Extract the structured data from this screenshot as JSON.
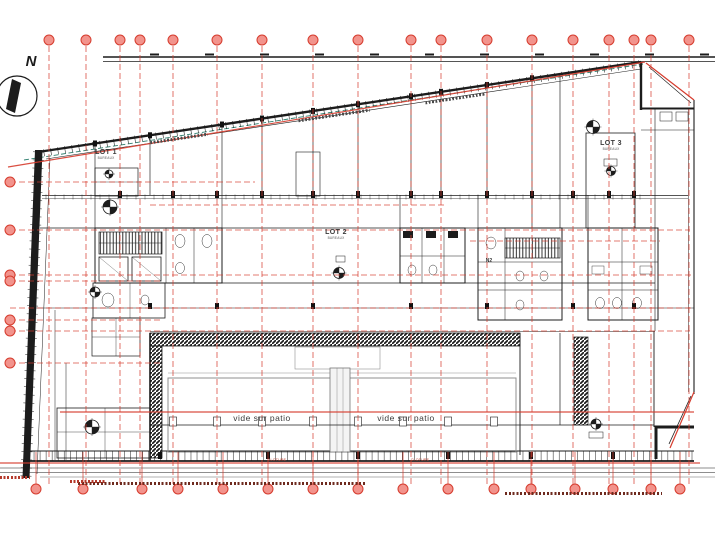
{
  "drawing": {
    "compass_label": "N",
    "lot1": {
      "label": "LOT 1",
      "sub": "BUREAUX"
    },
    "lot2": {
      "label": "LOT 2",
      "sub": "BUREAUX"
    },
    "lot3": {
      "label": "LOT 3",
      "sub": "BUREAUX"
    },
    "core_label_n2": "N2",
    "patio_label_left": "vide sur patio",
    "patio_label_right": "vide sur patio",
    "fence_label_left": "CLOTURE",
    "fence_label_right": "CLOTURE"
  },
  "colors": {
    "grid_red": "#d63c2e",
    "bubble_fill": "#f2938c",
    "line_black": "#1c1c1c",
    "teal_dash": "#2e7f6e"
  },
  "grid": {
    "top_bubbles_y": 40,
    "bottom_bubbles_y": 489,
    "line_top": 46,
    "line_bottom": 484,
    "columns_top": [
      49,
      86,
      120,
      140,
      173,
      217,
      262,
      313,
      358,
      411,
      441,
      487,
      532,
      573,
      609,
      634,
      651,
      689
    ],
    "columns_bottom": [
      36,
      83,
      142,
      178,
      223,
      268,
      313,
      358,
      403,
      448,
      494,
      531,
      575,
      613,
      651,
      680
    ],
    "rows": [
      {
        "y": 182,
        "x1": 10,
        "x2": 255,
        "bubble": true,
        "strong": false
      },
      {
        "y": 205,
        "x1": 150,
        "x2": 445,
        "bubble": false,
        "strong": false
      },
      {
        "y": 230,
        "x1": 10,
        "x2": 690,
        "bubble": true,
        "strong": false
      },
      {
        "y": 241,
        "x1": 470,
        "x2": 660,
        "bubble": false,
        "strong": false
      },
      {
        "y": 275,
        "x1": 10,
        "x2": 694,
        "bubble": true,
        "strong": false
      },
      {
        "y": 281,
        "x1": 10,
        "x2": 160,
        "bubble": true,
        "strong": false
      },
      {
        "y": 308,
        "x1": 10,
        "x2": 694,
        "bubble": false,
        "strong": false
      },
      {
        "y": 320,
        "x1": 10,
        "x2": 160,
        "bubble": true,
        "strong": false
      },
      {
        "y": 331,
        "x1": 10,
        "x2": 690,
        "bubble": true,
        "strong": false
      },
      {
        "y": 363,
        "x1": 10,
        "x2": 160,
        "bubble": true,
        "strong": false
      },
      {
        "y": 412,
        "x1": 60,
        "x2": 694,
        "bubble": false,
        "strong": true
      },
      {
        "y": 463,
        "x1": 0,
        "x2": 700,
        "bubble": false,
        "strong": true
      }
    ]
  }
}
